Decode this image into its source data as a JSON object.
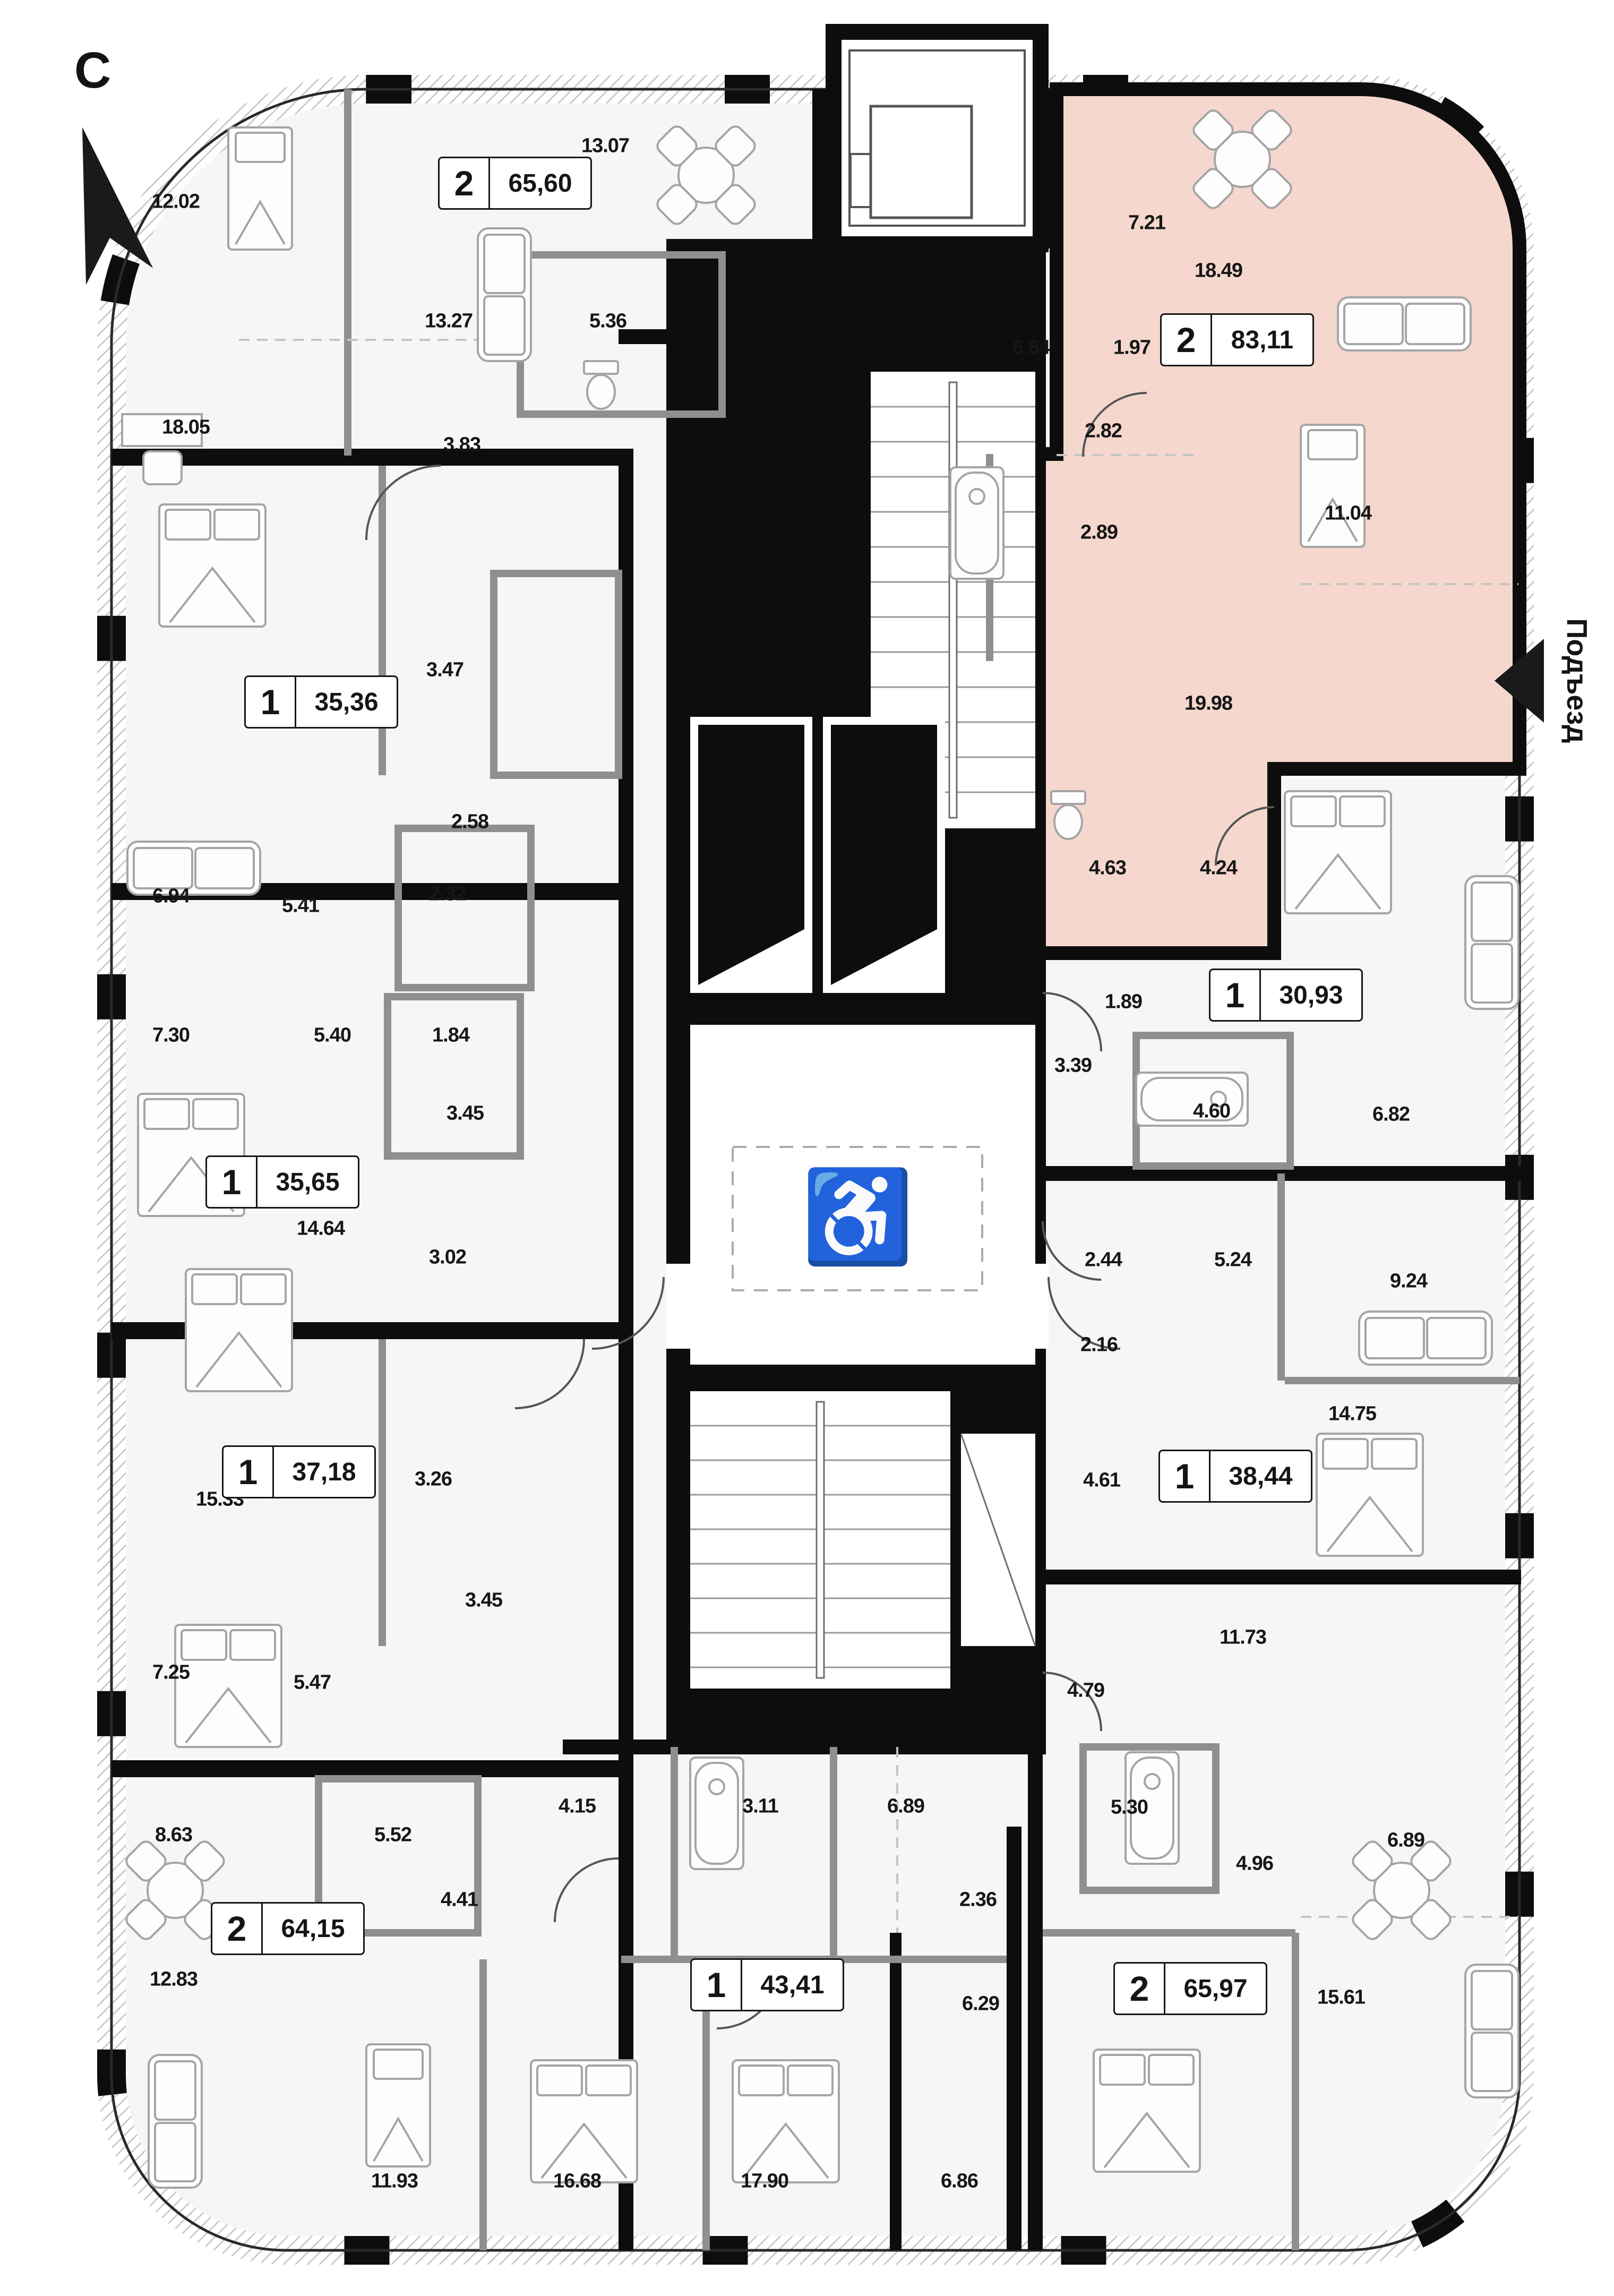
{
  "compass": {
    "label": "С"
  },
  "entrance": {
    "label": "Подъезд"
  },
  "icons": {
    "wheelchair": "♿"
  },
  "colors": {
    "highlight_fill": "#f5d7ce",
    "wall": "#0d0d0d",
    "partition": "#8f8f8f"
  },
  "apartments": [
    {
      "rooms": "2",
      "area": "65,60",
      "highlighted": false
    },
    {
      "rooms": "1",
      "area": "35,36",
      "highlighted": false
    },
    {
      "rooms": "1",
      "area": "35,65",
      "highlighted": false
    },
    {
      "rooms": "1",
      "area": "37,18",
      "highlighted": false
    },
    {
      "rooms": "2",
      "area": "64,15",
      "highlighted": false
    },
    {
      "rooms": "1",
      "area": "43,41",
      "highlighted": false
    },
    {
      "rooms": "2",
      "area": "83,11",
      "highlighted": true
    },
    {
      "rooms": "1",
      "area": "30,93",
      "highlighted": false
    },
    {
      "rooms": "1",
      "area": "38,44",
      "highlighted": false
    },
    {
      "rooms": "2",
      "area": "65,97",
      "highlighted": false
    }
  ],
  "room_labels": [
    "12.02",
    "13.07",
    "13.27",
    "5.36",
    "18.05",
    "3.83",
    "3.47",
    "2.58",
    "6.94",
    "5.41",
    "2.32",
    "7.30",
    "5.40",
    "1.84",
    "3.45",
    "14.64",
    "3.02",
    "15.33",
    "3.26",
    "3.45",
    "7.25",
    "5.47",
    "8.63",
    "5.52",
    "4.41",
    "12.83",
    "4.15",
    "3.11",
    "6.89",
    "2.36",
    "6.29",
    "11.93",
    "16.68",
    "17.90",
    "6.86",
    "7.21",
    "18.49",
    "6.64",
    "1.97",
    "2.82",
    "2.89",
    "11.04",
    "19.98",
    "4.63",
    "4.24",
    "1.89",
    "3.39",
    "4.60",
    "6.82",
    "2.44",
    "5.24",
    "9.24",
    "2.16",
    "14.75",
    "4.61",
    "11.73",
    "4.79",
    "5.30",
    "4.96",
    "6.89",
    "16.69",
    "15.61"
  ]
}
